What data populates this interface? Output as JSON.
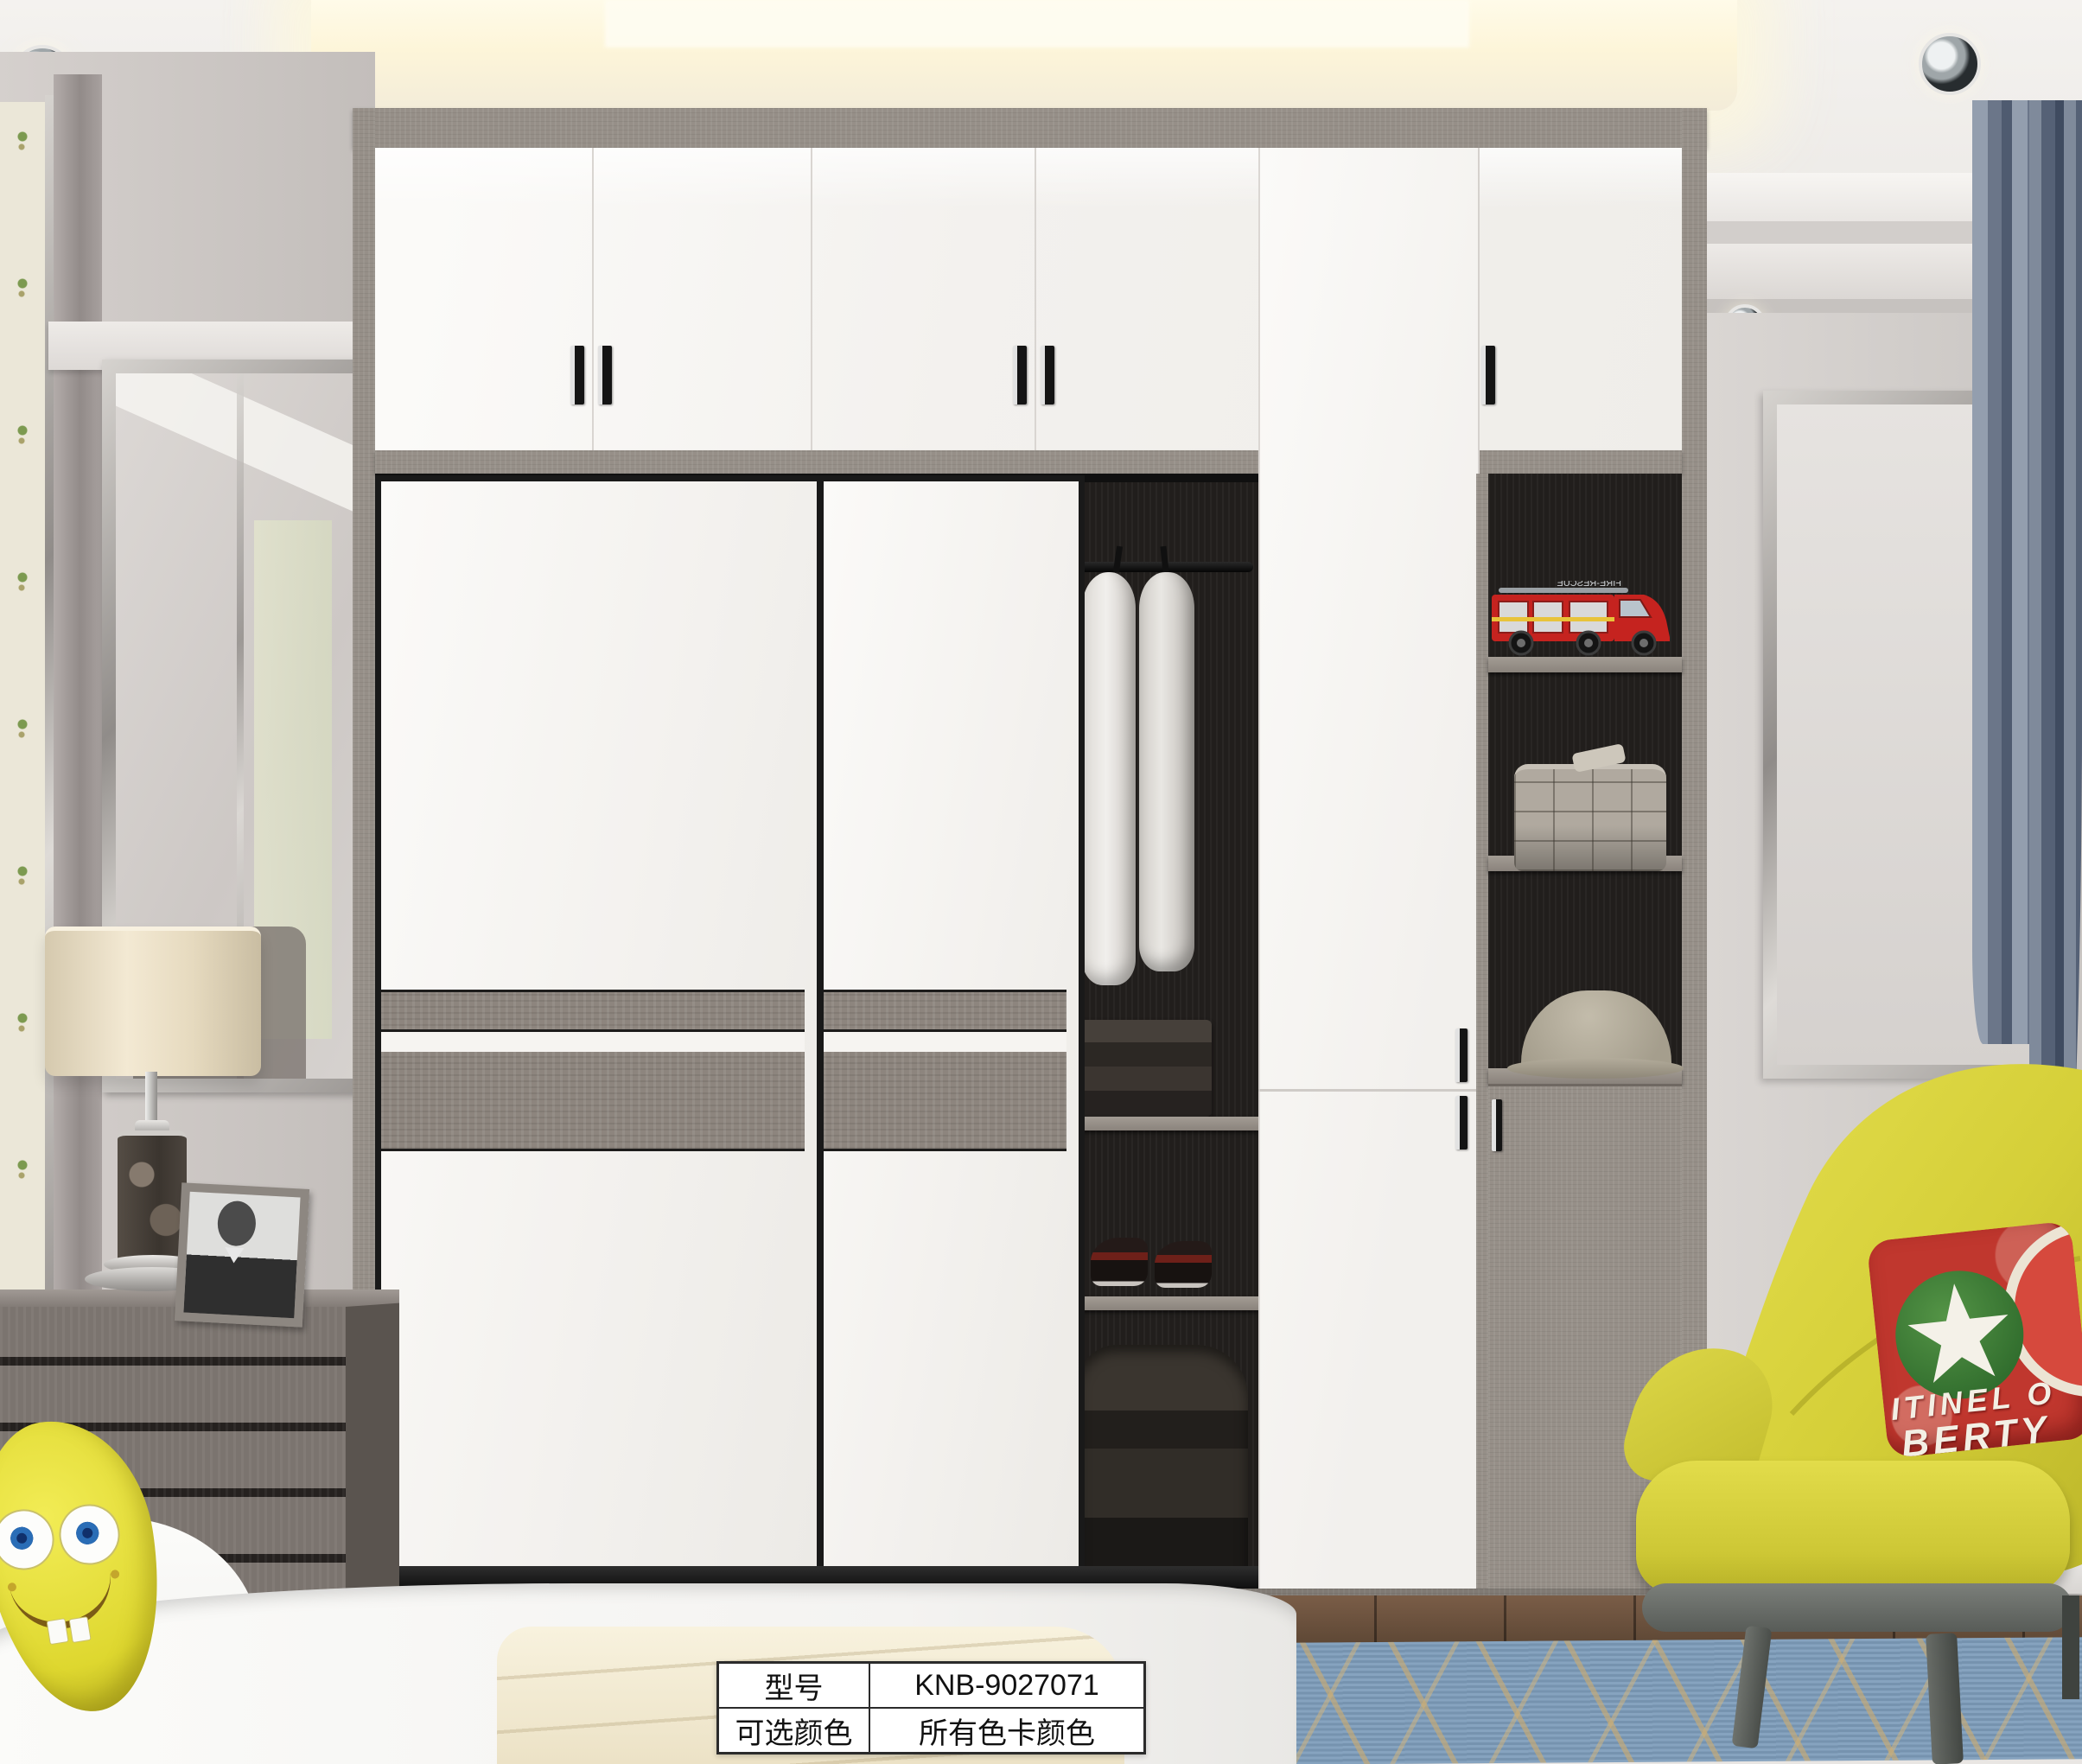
{
  "product_table": {
    "rows": [
      {
        "label": "型号",
        "value": "KNB-9027071"
      },
      {
        "label": "可选颜色",
        "value": "所有色卡颜色"
      }
    ]
  },
  "decor": {
    "pillow_text_line1": "ITINEL O",
    "pillow_text_line2": "BERTY",
    "truck_text": "FIRE-RESCUE"
  },
  "colors": {
    "cabinet_white": "#f5f3f0",
    "concrete_grey": "#968f88",
    "accent_yellow": "#d9d23c",
    "pillow_red": "#c0372e",
    "curtain_blue": "#6a7689",
    "rug_blue": "#7d9cba",
    "glow_warm": "#fdf7dd"
  }
}
